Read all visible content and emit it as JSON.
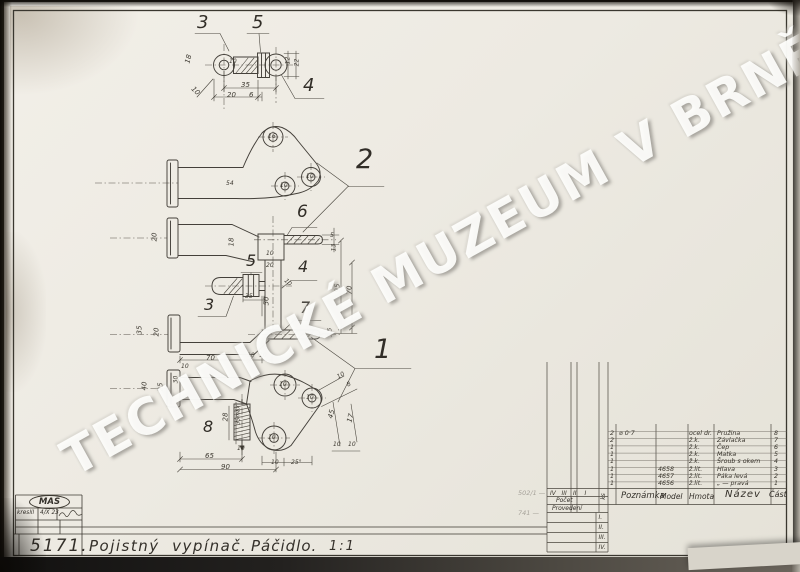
{
  "watermark": "TECHNICKÉ MUZEUM V BRNĚ",
  "title_block": {
    "drawing_number": "5171.",
    "title": "Pojistný  vypínač.",
    "subtitle": "Páčidlo.",
    "scale": "1:1"
  },
  "stamp_block": {
    "logo": "MAS",
    "kreslil_label": "kreslil",
    "date": "4/X 23"
  },
  "margin_notes": [
    "502/1 —",
    "741 —"
  ],
  "parts_table": {
    "headers": {
      "count_cols": [
        "IV",
        "III",
        "II",
        "I"
      ],
      "unit": "ks",
      "pocet": "Počet",
      "provedeni": "Provedení",
      "poznamka": "Poznámka",
      "model": "Model",
      "hmota": "Hmota",
      "nazev": "Název",
      "cast": "Část"
    },
    "version_rows": [
      "I.",
      "II.",
      "III.",
      "IV."
    ],
    "rows": [
      {
        "count": "2",
        "poznamka": "⌀ 0·7",
        "model": "",
        "hmota": "ocel dr.",
        "nazev": "Pružina",
        "cast": "8"
      },
      {
        "count": "2",
        "poznamka": "",
        "model": "",
        "hmota": "ž.k.",
        "nazev": "Závlačka",
        "cast": "7"
      },
      {
        "count": "1",
        "poznamka": "",
        "model": "",
        "hmota": "ž.k.",
        "nazev": "Čep",
        "cast": "6"
      },
      {
        "count": "1",
        "poznamka": "",
        "model": "",
        "hmota": "ž.k.",
        "nazev": "Matka",
        "cast": "5"
      },
      {
        "count": "1",
        "poznamka": "",
        "model": "",
        "hmota": "ž.k.",
        "nazev": "Šroub s okem",
        "cast": "4"
      },
      {
        "count": "1",
        "poznamka": "",
        "model": "4658",
        "hmota": "ž.lit.",
        "nazev": "Hlava",
        "cast": "3"
      },
      {
        "count": "1",
        "poznamka": "",
        "model": "4657",
        "hmota": "ž.lit.",
        "nazev": "Páka levá",
        "cast": "2"
      },
      {
        "count": "1",
        "poznamka": "",
        "model": "4656",
        "hmota": "ž.lit.",
        "nazev": "„ —  pravá",
        "cast": "1"
      }
    ]
  },
  "drawing": {
    "callouts": [
      {
        "t": "3",
        "x": 197,
        "y": 14,
        "s": 18
      },
      {
        "t": "5",
        "x": 252,
        "y": 14,
        "s": 18
      },
      {
        "t": "4",
        "x": 303,
        "y": 77,
        "s": 18
      },
      {
        "t": "2",
        "x": 356,
        "y": 146,
        "s": 27
      },
      {
        "t": "6",
        "x": 297,
        "y": 204,
        "s": 17
      },
      {
        "t": "5",
        "x": 246,
        "y": 253,
        "s": 16
      },
      {
        "t": "4",
        "x": 298,
        "y": 259,
        "s": 16
      },
      {
        "t": "3",
        "x": 204,
        "y": 297,
        "s": 16
      },
      {
        "t": "7",
        "x": 300,
        "y": 300,
        "s": 16
      },
      {
        "t": "1",
        "x": 374,
        "y": 336,
        "s": 27
      },
      {
        "t": "8",
        "x": 203,
        "y": 419,
        "s": 16
      }
    ],
    "dimensions": [
      {
        "t": "35",
        "x": 241,
        "y": 81
      },
      {
        "t": "20",
        "x": 227,
        "y": 91
      },
      {
        "t": "6",
        "x": 249,
        "y": 91
      },
      {
        "t": "18",
        "x": 184,
        "y": 55,
        "r": -75
      },
      {
        "t": "10",
        "x": 191,
        "y": 87,
        "r": 45
      },
      {
        "t": "10",
        "x": 229,
        "y": 58,
        "s": 6
      },
      {
        "t": "12",
        "x": 284,
        "y": 57,
        "r": -90,
        "s": 6
      },
      {
        "t": "22",
        "x": 293,
        "y": 59,
        "r": -90,
        "s": 6
      },
      {
        "t": "16",
        "x": 268,
        "y": 133,
        "s": 6
      },
      {
        "t": "10",
        "x": 280,
        "y": 182,
        "s": 6
      },
      {
        "t": "10",
        "x": 306,
        "y": 173,
        "s": 6
      },
      {
        "t": "54",
        "x": 226,
        "y": 180,
        "s": 6
      },
      {
        "t": "20",
        "x": 150,
        "y": 233,
        "r": -90
      },
      {
        "t": "18",
        "x": 227,
        "y": 238,
        "r": -90
      },
      {
        "t": "10",
        "x": 266,
        "y": 250,
        "s": 6
      },
      {
        "t": "20",
        "x": 266,
        "y": 262,
        "s": 6
      },
      {
        "t": "50",
        "x": 262,
        "y": 297,
        "r": -90
      },
      {
        "t": "35",
        "x": 245,
        "y": 293,
        "s": 6
      },
      {
        "t": "10",
        "x": 284,
        "y": 279,
        "r": 45,
        "s": 6
      },
      {
        "t": "5",
        "x": 330,
        "y": 232,
        "s": 6
      },
      {
        "t": "13",
        "x": 330,
        "y": 244,
        "r": -90,
        "s": 6
      },
      {
        "t": "95",
        "x": 333,
        "y": 284,
        "r": -90
      },
      {
        "t": "70",
        "x": 345,
        "y": 286,
        "r": -90
      },
      {
        "t": "3,5",
        "x": 325,
        "y": 329,
        "r": -90,
        "s": 6
      },
      {
        "t": "35",
        "x": 135,
        "y": 326,
        "r": -90
      },
      {
        "t": "20",
        "x": 152,
        "y": 328,
        "r": -90
      },
      {
        "t": "70",
        "x": 206,
        "y": 354
      },
      {
        "t": "10",
        "x": 247,
        "y": 352,
        "s": 6
      },
      {
        "t": "10",
        "x": 259,
        "y": 352,
        "s": 6
      },
      {
        "t": "40",
        "x": 140,
        "y": 382,
        "r": -90
      },
      {
        "t": "25",
        "x": 156,
        "y": 383,
        "r": -90
      },
      {
        "t": "10",
        "x": 181,
        "y": 363,
        "s": 6
      },
      {
        "t": "30",
        "x": 172,
        "y": 376,
        "r": -90,
        "s": 6
      },
      {
        "t": "10",
        "x": 279,
        "y": 381,
        "s": 6
      },
      {
        "t": "10",
        "x": 306,
        "y": 394,
        "s": 6
      },
      {
        "t": "10",
        "x": 268,
        "y": 434,
        "s": 6
      },
      {
        "t": "28",
        "x": 221,
        "y": 413,
        "r": -90
      },
      {
        "t": "35máx",
        "x": 229,
        "y": 412,
        "r": -90,
        "s": 5.6
      },
      {
        "t": "10",
        "x": 237,
        "y": 445,
        "s": 6
      },
      {
        "t": "65",
        "x": 205,
        "y": 452
      },
      {
        "t": "90",
        "x": 221,
        "y": 463
      },
      {
        "t": "10",
        "x": 271,
        "y": 459,
        "s": 6
      },
      {
        "t": "25°",
        "x": 291,
        "y": 459,
        "s": 6
      },
      {
        "t": "10",
        "x": 337,
        "y": 372,
        "r": -30,
        "s": 6
      },
      {
        "t": "8",
        "x": 347,
        "y": 381,
        "r": -30,
        "s": 6
      },
      {
        "t": "45",
        "x": 327,
        "y": 410,
        "r": -75
      },
      {
        "t": "17",
        "x": 346,
        "y": 414,
        "r": -75
      },
      {
        "t": "10",
        "x": 333,
        "y": 441,
        "s": 6
      },
      {
        "t": "10",
        "x": 348,
        "y": 441,
        "s": 6
      }
    ]
  }
}
